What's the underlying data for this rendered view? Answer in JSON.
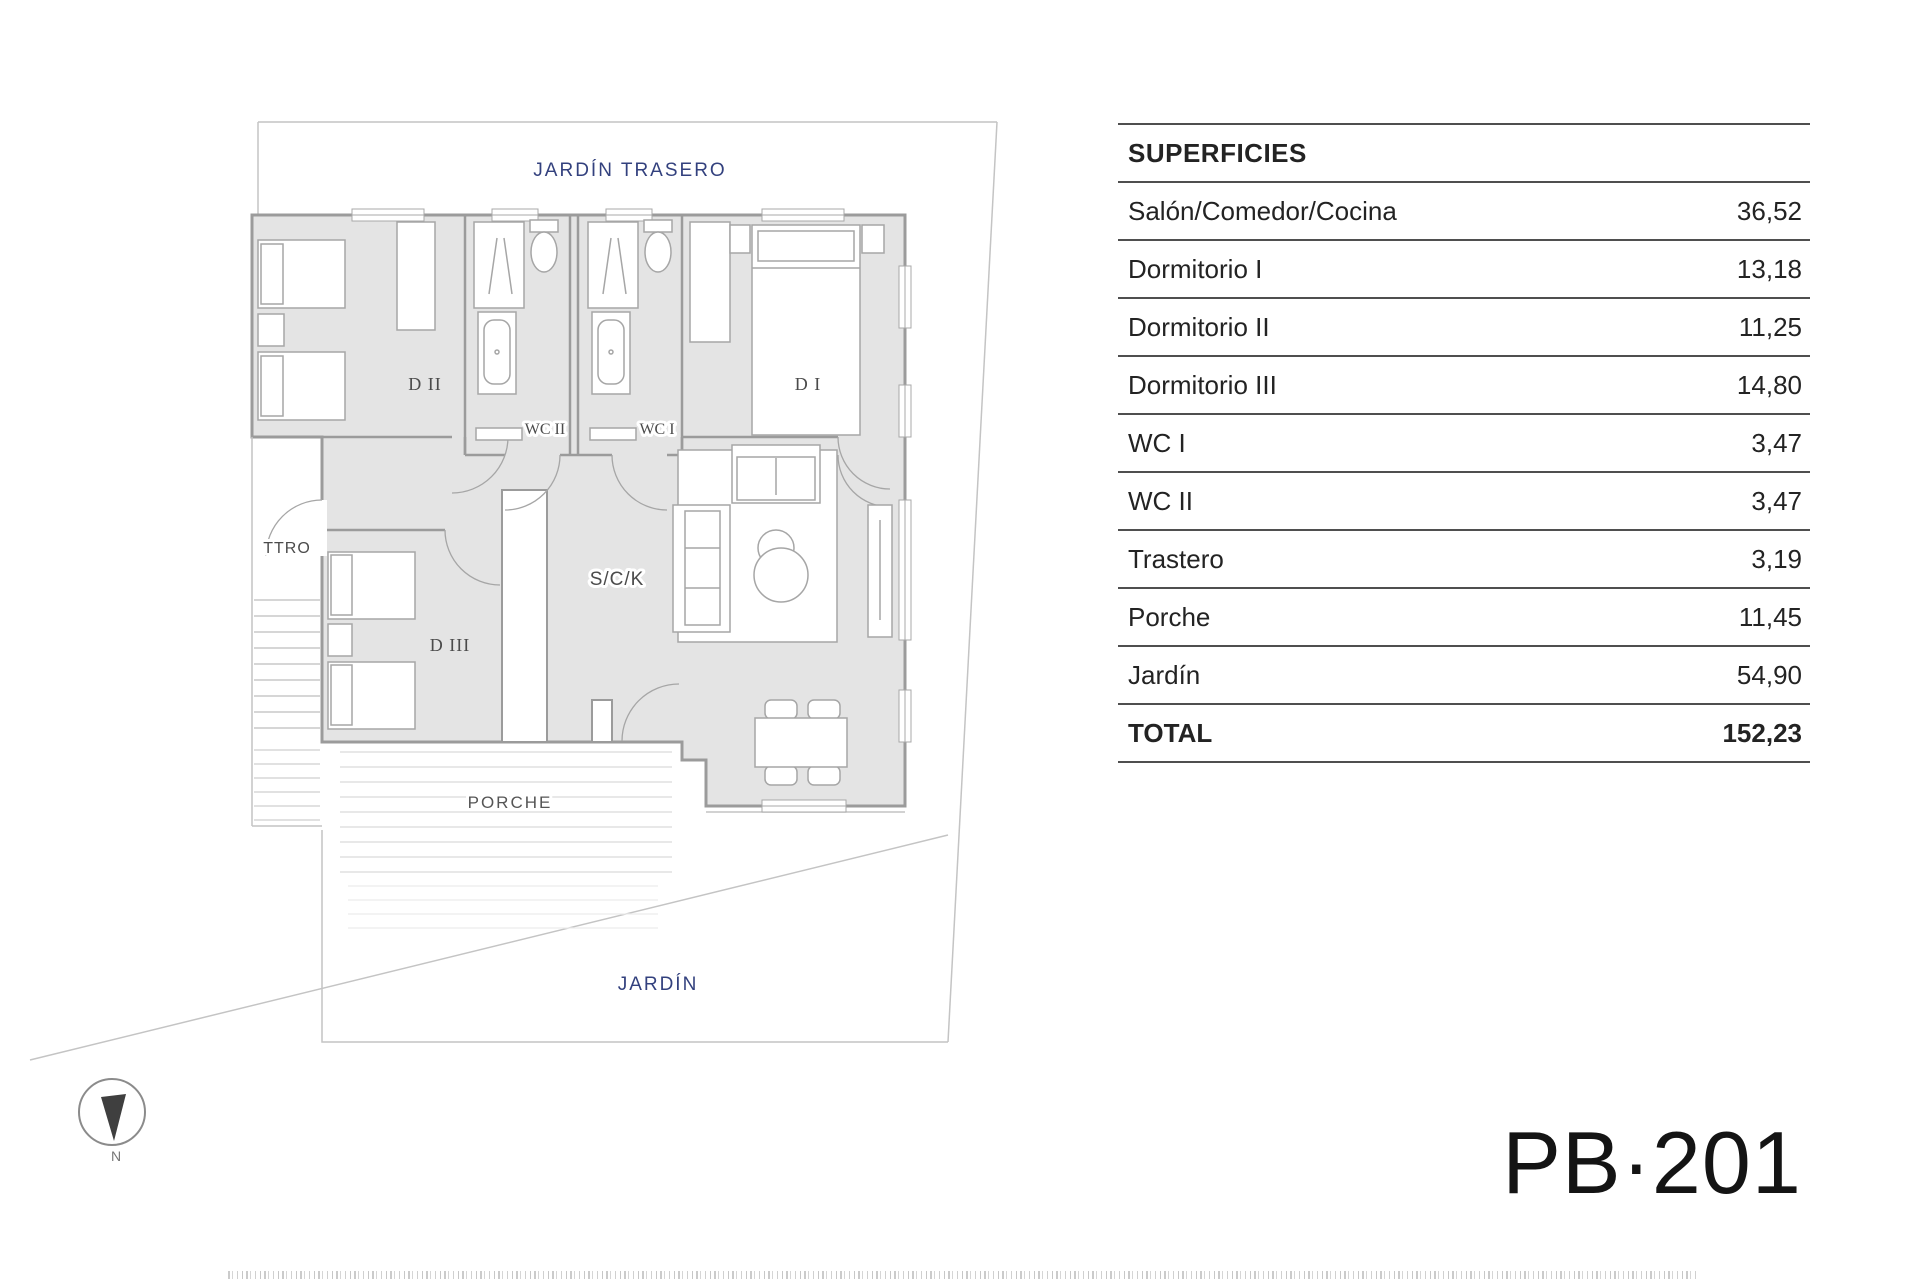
{
  "plan": {
    "back_garden_label": "JARDÍN TRASERO",
    "garden_label": "JARDÍN",
    "porch_label": "PORCHE",
    "rooms": {
      "d1": "D I",
      "d2": "D II",
      "d3": "D III",
      "wc1": "WC I",
      "wc2": "WC II",
      "sck": "S/C/K",
      "ttro": "TTRO"
    },
    "compass_north": "N",
    "colors": {
      "garden_label_navy": "#33417e",
      "room_label_gray": "#4b4b4b",
      "wall_gray": "#9b9b9b",
      "floor_fill": "#e4e4e4"
    }
  },
  "table": {
    "title": "SUPERFICIES",
    "rows": [
      {
        "label": "Salón/Comedor/Cocina",
        "value": "36,52"
      },
      {
        "label": "Dormitorio I",
        "value": "13,18"
      },
      {
        "label": "Dormitorio II",
        "value": "11,25"
      },
      {
        "label": "Dormitorio III",
        "value": "14,80"
      },
      {
        "label": "WC I",
        "value": "3,47"
      },
      {
        "label": "WC II",
        "value": "3,47"
      },
      {
        "label": "Trastero",
        "value": "3,19"
      },
      {
        "label": "Porche",
        "value": "11,45"
      },
      {
        "label": "Jardín",
        "value": "54,90"
      }
    ],
    "total": {
      "label": "TOTAL",
      "value": "152,23"
    }
  },
  "plan_code": "PB·201"
}
